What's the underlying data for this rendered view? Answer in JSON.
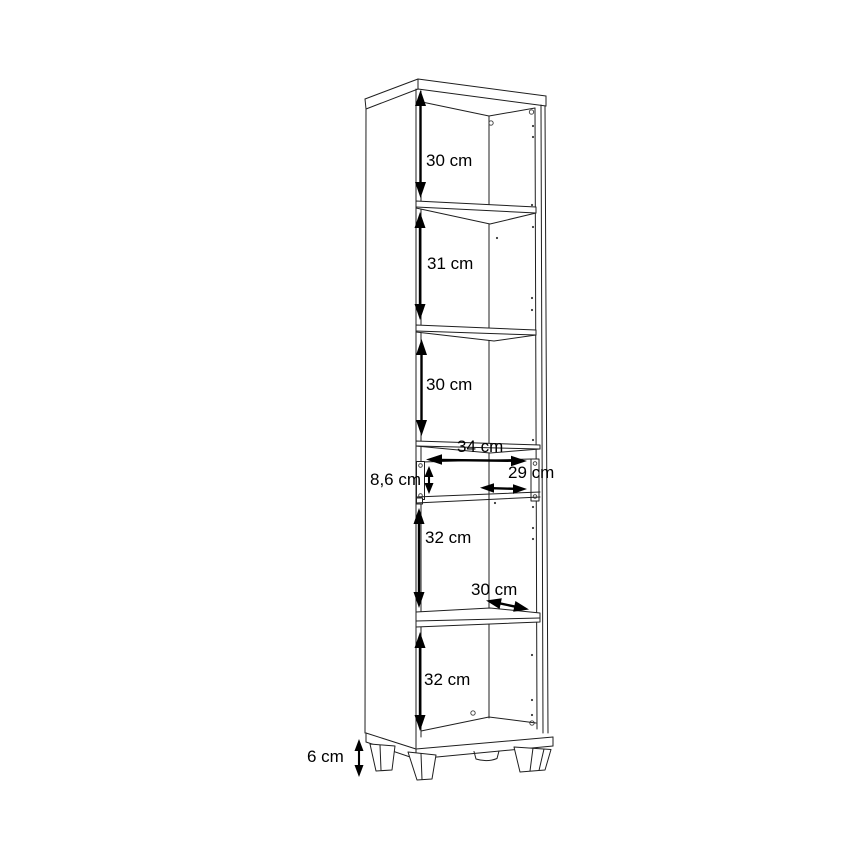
{
  "canvas": {
    "width": 868,
    "height": 868,
    "background": "#ffffff",
    "line_color": "#1f1f1f",
    "text_color": "#000000"
  },
  "diagram": {
    "type": "furniture-dimension-drawing",
    "subject": "tall narrow cabinet with five open compartments, one drawer and four feet",
    "dimensions": [
      {
        "id": "top-compartment-height",
        "label": "30 cm",
        "orientation": "vertical"
      },
      {
        "id": "second-compartment-height",
        "label": "31 cm",
        "orientation": "vertical"
      },
      {
        "id": "third-compartment-height",
        "label": "30 cm",
        "orientation": "vertical"
      },
      {
        "id": "interior-width",
        "label": "34 cm",
        "orientation": "horizontal"
      },
      {
        "id": "drawer-front-height",
        "label": "8,6 cm",
        "orientation": "vertical"
      },
      {
        "id": "drawer-inner-width",
        "label": "29 cm",
        "orientation": "horizontal"
      },
      {
        "id": "fourth-compartment-height",
        "label": "32 cm",
        "orientation": "vertical"
      },
      {
        "id": "shelf-depth",
        "label": "30 cm",
        "orientation": "diagonal"
      },
      {
        "id": "bottom-compartment-height",
        "label": "32 cm",
        "orientation": "vertical"
      },
      {
        "id": "feet-height",
        "label": "6 cm",
        "orientation": "vertical"
      }
    ]
  }
}
